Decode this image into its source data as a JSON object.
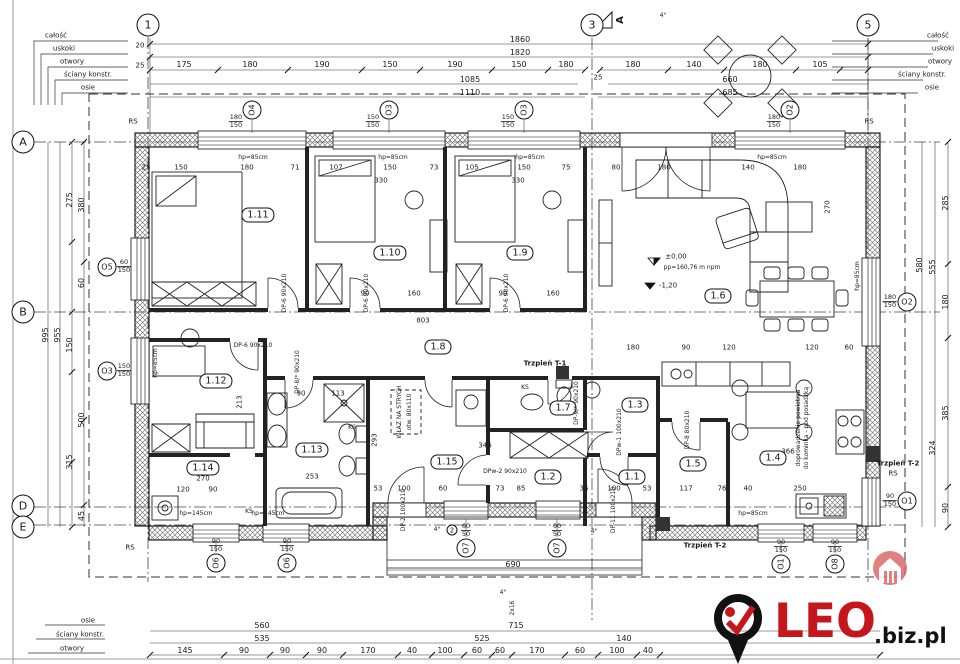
{
  "colors": {
    "line": "#1a1a1a",
    "logo_red": "#c4161c",
    "logo_black": "#111111",
    "watermark": "#dd6a6a"
  },
  "legend": {
    "items": [
      "całość",
      "uskoki",
      "otwory",
      "ściany konstr.",
      "osie"
    ]
  },
  "grid": {
    "c1": "1",
    "c2": "3",
    "c3": "5",
    "rA": "A",
    "rB": "B",
    "rD": "D",
    "rE": "E"
  },
  "section": {
    "label": "A"
  },
  "markers": {
    "rs": "RS",
    "t1": "Trzpień T-1",
    "t2": "Trzpień T-2",
    "ks": "KS",
    "step_circle": "2",
    "stairs": "2x16",
    "slope": "4°"
  },
  "levels": {
    "zero": "±0,00",
    "pp": "pp=160,76 m npm",
    "minus": "-1,20"
  },
  "attic": {
    "line1": "WŁAZ NA STRYCH",
    "line2": "otw. 80x110"
  },
  "kitchen_note": {
    "line1": "doprowadzenie powietrza",
    "line2": "do kominka - pod posadzką"
  },
  "hp": {
    "h85": "hp=85cm",
    "h145": "hp=145cm"
  },
  "rooms": {
    "r1_11": "1.11",
    "r1_10": "1.10",
    "r1_9": "1.9",
    "r1_6": "1.6",
    "r1_8": "1.8",
    "r1_12": "1.12",
    "r1_13": "1.13",
    "r1_14": "1.14",
    "r1_15": "1.15",
    "r1_7": "1.7",
    "r1_2": "1.2",
    "r1_3": "1.3",
    "r1_1": "1.1",
    "r1_5": "1.5",
    "r1_4": "1.4"
  },
  "windows": {
    "o1": "O1",
    "o2": "O2",
    "o3": "O3",
    "o4": "O4",
    "o5": "O5",
    "o6": "O6",
    "o7": "O7",
    "o8": "O8"
  },
  "window_sizes": {
    "o4t": [
      "180",
      "150"
    ],
    "o3t": [
      "150",
      "150"
    ],
    "o2t": [
      "180",
      "150"
    ],
    "o5": [
      "60",
      "150"
    ],
    "o3l": [
      "150",
      "150"
    ],
    "o2r": [
      "180",
      "150"
    ],
    "o1r": [
      "90",
      "150"
    ],
    "o6": [
      "90",
      "150"
    ],
    "o7": [
      "60",
      "50"
    ],
    "o1b": [
      "90",
      "150"
    ],
    "o8": [
      "90",
      "150"
    ]
  },
  "doors": {
    "dp6": {
      "name": "DP-6",
      "size": "90x210"
    },
    "dp8s": {
      "name": "DP-8/*",
      "size": "90x210"
    },
    "dp9": {
      "name": "DP-9/*",
      "size": "90x210"
    },
    "dp8": {
      "name": "DP-8",
      "size": "80x210"
    },
    "dpw1": {
      "name": "DPw-1",
      "size": "100x210"
    },
    "dpw2": {
      "name": "DPw-2",
      "size": "90x210"
    },
    "dp2": {
      "name": "DP-2",
      "size": "100x210"
    },
    "dp11": {
      "name": "DP-11",
      "size": "100x210"
    }
  },
  "dims": {
    "top": {
      "total": "1860",
      "row2": "1820",
      "segs_left": [
        "175",
        "180",
        "190",
        "150",
        "190",
        "150",
        "180"
      ],
      "segs_right": [
        "180",
        "140",
        "180",
        "105"
      ],
      "row4_left": "1085",
      "row4_right": "660",
      "row5_left": "1110",
      "row5_right": "685",
      "edge1": "20",
      "edge2": "25",
      "mid": "25"
    },
    "left": {
      "total": "995",
      "row2": "955",
      "col1": [
        "275",
        "150",
        "315"
      ],
      "col2": [
        "380",
        "60",
        "500",
        "45"
      ]
    },
    "right": {
      "col1": [
        "285",
        "180",
        "385",
        "90"
      ],
      "col2": [
        "555",
        "324"
      ],
      "col3": [
        "580"
      ]
    },
    "bottom": {
      "porch": "690",
      "row1": [
        "560",
        "715"
      ],
      "row2": [
        "535",
        "525",
        "140"
      ],
      "segs": [
        "145",
        "90",
        "90",
        "90",
        "170",
        "40",
        "100",
        "60",
        "60",
        "170",
        "60",
        "100",
        "40"
      ]
    },
    "inner": [
      "25",
      "150",
      "180",
      "71",
      "107",
      "150",
      "73",
      "105",
      "150",
      "75",
      "80",
      "180",
      "140",
      "180",
      "330",
      "330",
      "90",
      "160",
      "90",
      "160",
      "803",
      "180",
      "346",
      "293",
      "113",
      "90",
      "270",
      "253",
      "120",
      "90",
      "53",
      "100",
      "60",
      "73",
      "85",
      "35",
      "100",
      "53",
      "117",
      "76",
      "40",
      "250",
      "90",
      "120",
      "120",
      "60",
      "366",
      "270",
      "213"
    ]
  },
  "logo": {
    "brand": "LEO",
    "suffix": ".biz.pl"
  }
}
